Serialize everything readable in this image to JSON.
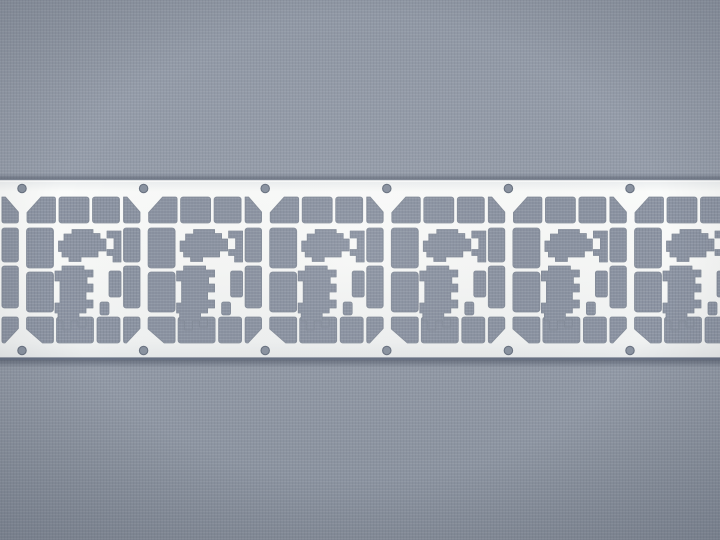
{
  "scene": {
    "type": "photograph",
    "description": "Macro photograph of a stamped sheet-metal lead frame strip (SIM-card style contact frames) lying horizontally across the center of a blue-gray woven fabric background",
    "object": "metal lead frame strip",
    "background": "blue-gray woven fabric",
    "orientation": "horizontal"
  },
  "palette": {
    "fabric_base": "#939BA8",
    "fabric_dark": "#8A92A0",
    "cutout_base": "#8C94A3",
    "weave_light": "rgba(255,255,255,0.09)",
    "weave_dark": "rgba(25,32,48,0.07)",
    "metal_white": "#F7F8F7",
    "metal_edge_light": "#E7EAEC",
    "cut_edge": "#848C99",
    "strip_top_edge": "#7E8694",
    "strip_bottom_edge": "#667083",
    "hole_fill": "#8A93A1",
    "hole_rim": "#6A7382"
  },
  "canvas": {
    "width": 720,
    "height": 540
  },
  "strip": {
    "top_y": 179,
    "bottom_y": 359.5,
    "cell_period_px": 121.6,
    "cell_origins": [
      -99.6,
      22,
      143.6,
      265.2,
      386.8,
      508.4,
      630
    ],
    "visible_cells": 7,
    "full_cells": 5,
    "sprocket_holes_per_rail": 6,
    "hole_radius": 4.2,
    "hole_top_cy": 188.5,
    "hole_bottom_cy": 350.5
  }
}
